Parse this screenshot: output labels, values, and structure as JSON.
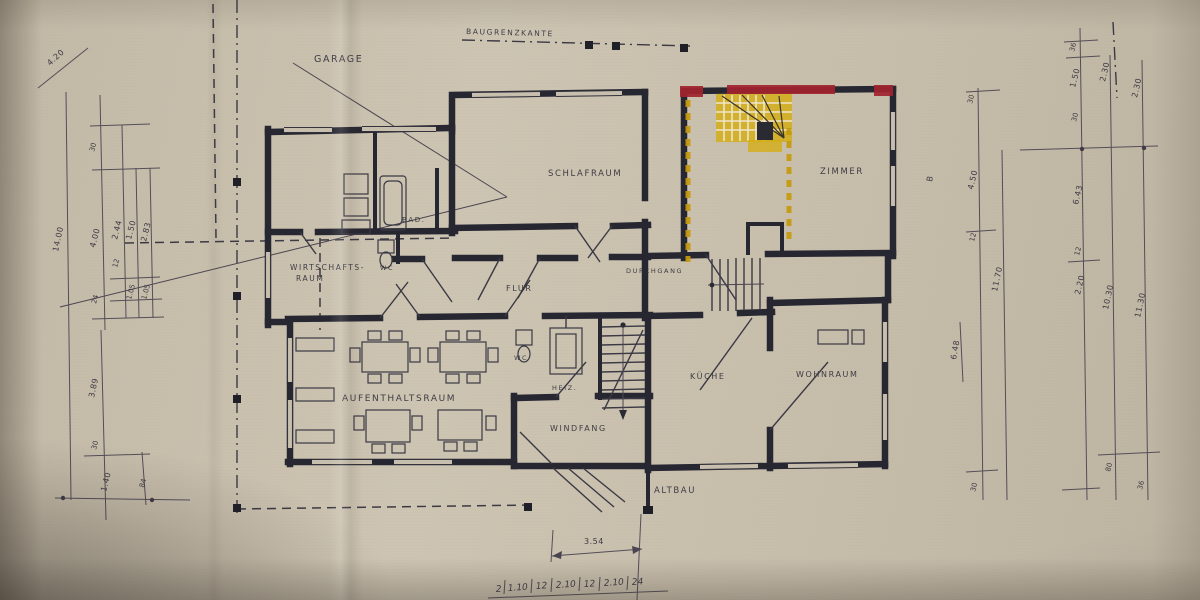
{
  "labels": {
    "garage": "GARAGE",
    "boundary": "BAUGRENZKANTE",
    "schlafraum": "SCHLAFRAUM",
    "zimmer": "ZIMMER",
    "bad": "BAD.",
    "wc_upper": "WC",
    "wirtschaft_line1": "WIRTSCHAFTS-",
    "wirtschaft_line2": "RAUM",
    "flur": "FLUR",
    "durchgang": "DURCHGANG",
    "aufenthaltsraum": "AUFENTHALTSRAUM",
    "wc_lower": "WC",
    "heiz": "HEIZ.",
    "kueche": "KÜCHE",
    "wohnraum": "WOHNRAUM",
    "windfang": "WINDFANG",
    "altbau": "ALTBAU",
    "section_mark": "B"
  },
  "dims": {
    "top_left": "4.20",
    "left_outer": "14.00",
    "L2": [
      "30",
      "4.00",
      "24"
    ],
    "L3": [
      "2.44",
      "12",
      "1.50",
      "1.05"
    ],
    "L4": [
      "2.83",
      "1.05"
    ],
    "lower_left": [
      "3.89",
      "30",
      "1.40",
      "84"
    ],
    "R1": [
      "30",
      "4.50",
      "12",
      "30"
    ],
    "R2": [
      "11.70"
    ],
    "R3": [
      "36",
      "1.50",
      "30",
      "6.43",
      "12",
      "2.20"
    ],
    "R4": [
      "2.30",
      "10.30",
      "80"
    ],
    "R5": [
      "2.30",
      "11.30",
      "36"
    ],
    "extra_648": "6.48",
    "bottom_width": "3.54",
    "bottom_chain": [
      "2",
      "1.10",
      "12",
      "2.10",
      "12",
      "2.10",
      "24"
    ]
  },
  "colors": {
    "paper": "#c8bfae",
    "ink": "#272732",
    "highlight_yellow": "#d4ae17",
    "highlight_red": "#a2232e"
  }
}
